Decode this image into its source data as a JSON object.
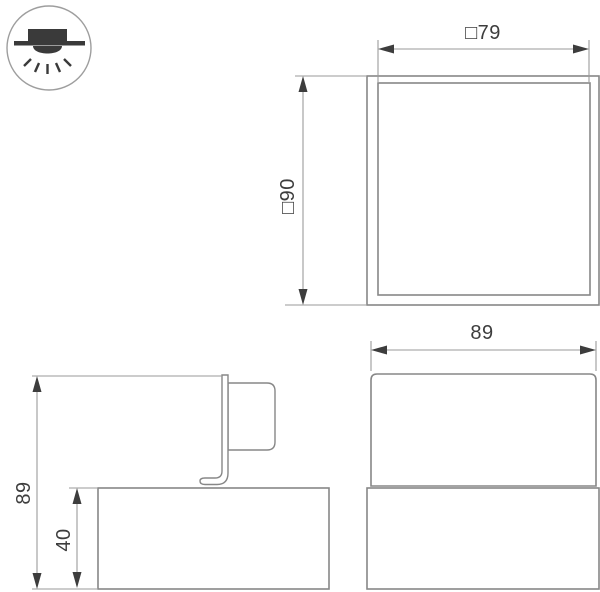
{
  "drawing": {
    "type": "luminaire-dimension-drawing",
    "icon": {
      "name": "surface-mounted-downlight-icon"
    },
    "colors": {
      "background": "#ffffff",
      "object_line": "#878787",
      "dimension_line": "#9a9a9a",
      "arrow": "#3d3d3d",
      "text": "#3d3d3d",
      "icon_dark": "#3a3a3a",
      "icon_circle": "#9e9e9e"
    },
    "views": {
      "top": {
        "name": "top-view",
        "width_label": "□79",
        "height_label": "□90"
      },
      "side": {
        "name": "side-view",
        "height_label": "89",
        "base_height_label": "40"
      },
      "front": {
        "name": "front-view",
        "width_label": "89"
      }
    }
  }
}
